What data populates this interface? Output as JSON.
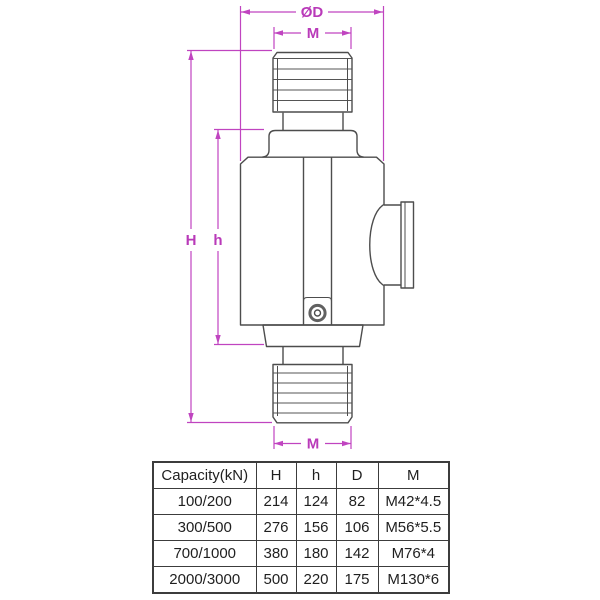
{
  "diagram": {
    "labels": {
      "outer_diameter": "ØD",
      "thread_top": "M",
      "total_height": "H",
      "body_height": "h",
      "thread_bottom": "M"
    },
    "colors": {
      "dimension": "#c044c0",
      "outline": "#4d4d4d"
    }
  },
  "table": {
    "headers": [
      "Capacity(kN)",
      "H",
      "h",
      "D",
      "M"
    ],
    "rows": [
      [
        "100/200",
        "214",
        "124",
        "82",
        "M42*4.5"
      ],
      [
        "300/500",
        "276",
        "156",
        "106",
        "M56*5.5"
      ],
      [
        "700/1000",
        "380",
        "180",
        "142",
        "M76*4"
      ],
      [
        "2000/3000",
        "500",
        "220",
        "175",
        "M130*6"
      ]
    ]
  }
}
